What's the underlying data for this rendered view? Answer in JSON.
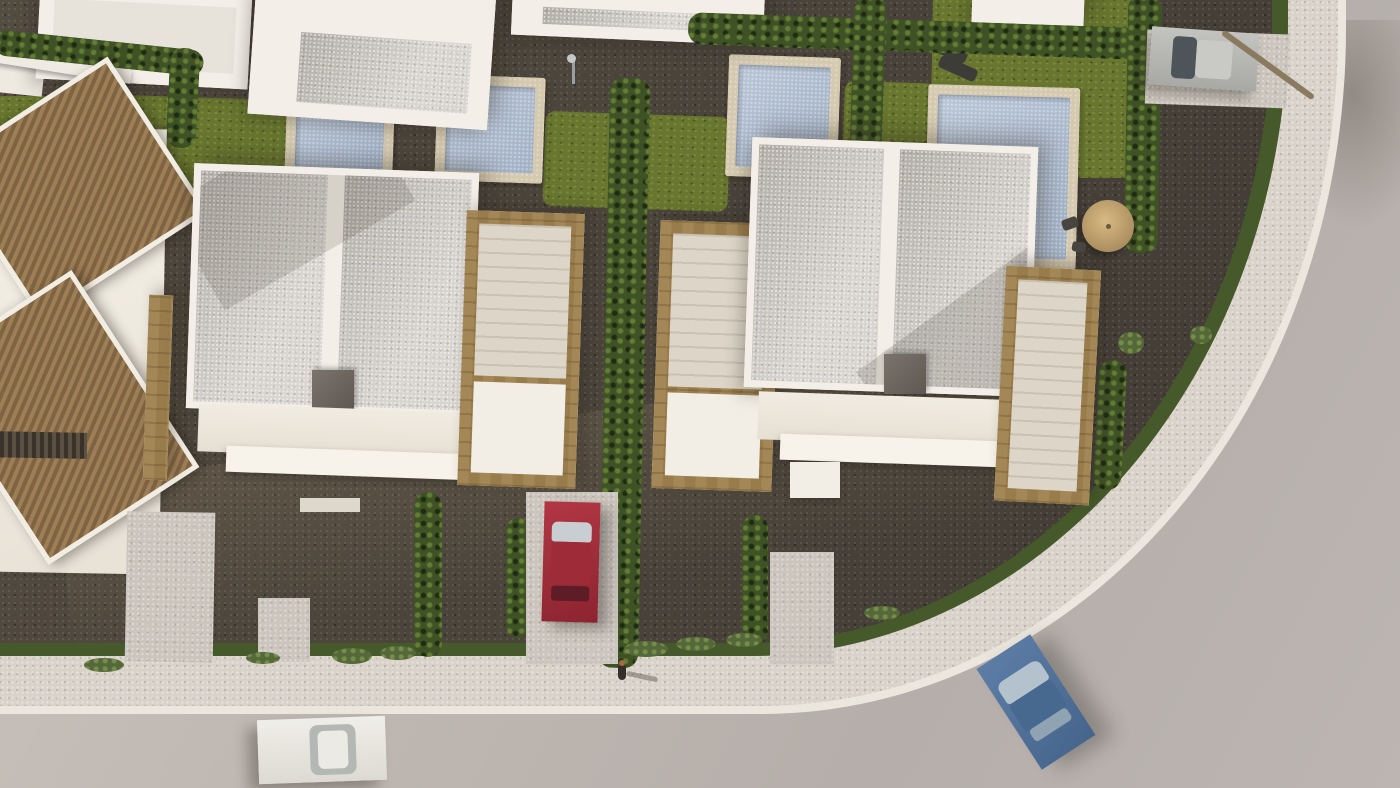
{
  "scene": {
    "title": "Aerial 3D architectural render of a new-build villa development with private pools, gravel gardens and a curved road",
    "view": "top-down aerial, warm late-afternoon light",
    "buildings": {
      "new_villas": [
        {
          "label": "New villa A",
          "roof": "flat gray gravel roof with white parapet",
          "features": [
            "rooftop chimney box",
            "travertine stair terraces",
            "two dark facade windows",
            "glazed ground floor"
          ]
        },
        {
          "label": "New villa B",
          "roof": "flat gray gravel roof with white parapet",
          "features": [
            "rooftop chimney box",
            "travertine stair terraces",
            "two dark facade windows",
            "glazed ground floor"
          ]
        }
      ],
      "existing_house": {
        "label": "Existing house with terracotta tiled pitched roofs"
      },
      "neighbor_row": {
        "label": "White villas along the top edge",
        "count": 4
      }
    },
    "pools": [
      {
        "label": "Pool behind villa A",
        "water_color": "#a9b9cc",
        "deck_color": "#d5cab0"
      },
      {
        "label": "Pool between the villas",
        "water_color": "#a9b9cc",
        "deck_color": "#d5cab0"
      },
      {
        "label": "Pool behind villa B",
        "water_color": "#a9b9cc",
        "deck_color": "#d5cab0"
      },
      {
        "label": "Corner-garden pool with lawn and sun loungers",
        "water_color": "#a9b9cc",
        "deck_color": "#d5cab0"
      },
      {
        "label": "Small pool of the existing house",
        "water_color": "#b6c3d4"
      }
    ],
    "vehicles": [
      {
        "label": "Red car parked in driveway",
        "color": "#9e2c38"
      },
      {
        "label": "White car on road, bottom left",
        "color": "#eceae4"
      },
      {
        "label": "Blue car driving on road, bottom right",
        "color": "#50719a"
      },
      {
        "label": "Silver car in driveway, top right",
        "color": "#b9bab6"
      }
    ],
    "people": [
      {
        "label": "Pedestrian walking on the sidewalk",
        "location": "bottom center"
      }
    ],
    "landscape": {
      "road_color": "#b8b1ad",
      "sidewalk_color": "#d8d2c9",
      "curb_color": "#ece7de",
      "gravel_color": "#48423a",
      "lawn_color": "#68762f",
      "hedge_color": "#3f5226",
      "travertine_color": "#cbb892",
      "terracotta_color": "#8d6f4a",
      "palm_count": 12,
      "flowering": [
        "purple bougainvillea",
        "pink shrubs",
        "white flower beds",
        "lavender balls",
        "hydrangea bed"
      ],
      "furniture": [
        "two sun loungers by corner pool",
        "tan parasol with bistro chairs",
        "outdoor showers",
        "stepping-stone paths"
      ]
    }
  }
}
